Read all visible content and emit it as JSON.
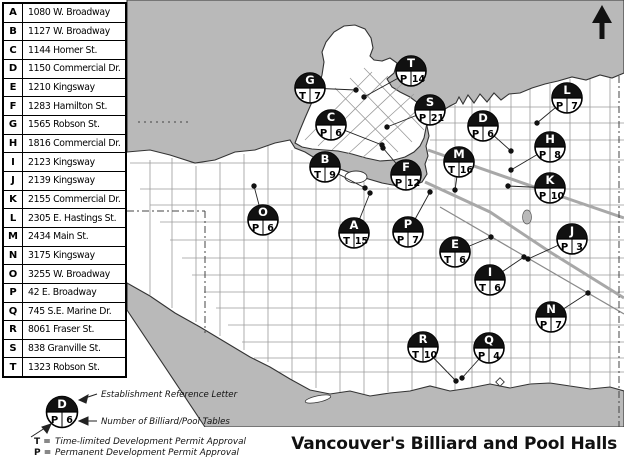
{
  "title": "Vancouver's Billiard and Pool Halls",
  "table": {
    "rows": [
      {
        "letter": "A",
        "address": "1080 W. Broadway"
      },
      {
        "letter": "B",
        "address": "1127 W. Broadway"
      },
      {
        "letter": "C",
        "address": "1144 Homer St."
      },
      {
        "letter": "D",
        "address": "1150 Commercial Dr."
      },
      {
        "letter": "E",
        "address": "1210 Kingsway"
      },
      {
        "letter": "F",
        "address": "1283 Hamilton St."
      },
      {
        "letter": "G",
        "address": "1565 Robson St."
      },
      {
        "letter": "H",
        "address": "1816 Commercial Dr."
      },
      {
        "letter": "I",
        "address": "2123 Kingsway"
      },
      {
        "letter": "J",
        "address": "2139 Kingsway"
      },
      {
        "letter": "K",
        "address": "2155 Commercial Dr."
      },
      {
        "letter": "L",
        "address": "2305 E. Hastings St."
      },
      {
        "letter": "M",
        "address": "2434 Main St."
      },
      {
        "letter": "N",
        "address": "3175 Kingsway"
      },
      {
        "letter": "O",
        "address": "3255 W. Broadway"
      },
      {
        "letter": "P",
        "address": "42 E. Broadway"
      },
      {
        "letter": "Q",
        "address": "745 S.E. Marine Dr."
      },
      {
        "letter": "R",
        "address": "8061 Fraser St."
      },
      {
        "letter": "S",
        "address": "838 Granville St."
      },
      {
        "letter": "T",
        "address": "1323 Robson St."
      }
    ]
  },
  "legend": {
    "sample": {
      "letter": "D",
      "permit": "P",
      "tables": "6",
      "x": 62,
      "y": 34
    },
    "ref_label": "Establishment Reference Letter",
    "tables_label": "Number of Billiard/Pool Tables",
    "permit_lines": [
      {
        "symbol": "T =",
        "text": "Time-limited Development Permit Approval"
      },
      {
        "symbol": "P =",
        "text": "Permanent Development Permit Approval"
      }
    ]
  },
  "map": {
    "colors": {
      "water": "#b9b9b9",
      "land": "#ffffff",
      "street": "#9b9b9b",
      "major_road": "#a8a8a8",
      "marker_fill": "#111111",
      "outline": "#333333"
    },
    "markers": [
      {
        "letter": "A",
        "permit": "T",
        "tables": "15",
        "x": 354,
        "y": 233,
        "dotx": 370,
        "doty": 193
      },
      {
        "letter": "B",
        "permit": "T",
        "tables": "9",
        "x": 325,
        "y": 167,
        "dotx": 365,
        "doty": 188
      },
      {
        "letter": "C",
        "permit": "P",
        "tables": "6",
        "x": 331,
        "y": 125,
        "dotx": 382,
        "doty": 145
      },
      {
        "letter": "D",
        "permit": "P",
        "tables": "6",
        "x": 483,
        "y": 126,
        "dotx": 511,
        "doty": 151
      },
      {
        "letter": "E",
        "permit": "T",
        "tables": "6",
        "x": 455,
        "y": 252,
        "dotx": 491,
        "doty": 237
      },
      {
        "letter": "F",
        "permit": "P",
        "tables": "12",
        "x": 406,
        "y": 175,
        "dotx": 383,
        "doty": 148
      },
      {
        "letter": "G",
        "permit": "T",
        "tables": "7",
        "x": 310,
        "y": 88,
        "dotx": 356,
        "doty": 90
      },
      {
        "letter": "H",
        "permit": "P",
        "tables": "8",
        "x": 550,
        "y": 147,
        "dotx": 511,
        "doty": 170
      },
      {
        "letter": "I",
        "permit": "T",
        "tables": "6",
        "x": 490,
        "y": 280,
        "dotx": 524,
        "doty": 257
      },
      {
        "letter": "J",
        "permit": "P",
        "tables": "3",
        "x": 572,
        "y": 239,
        "dotx": 528,
        "doty": 259
      },
      {
        "letter": "K",
        "permit": "P",
        "tables": "10",
        "x": 550,
        "y": 188,
        "dotx": 508,
        "doty": 186
      },
      {
        "letter": "L",
        "permit": "P",
        "tables": "7",
        "x": 567,
        "y": 98,
        "dotx": 537,
        "doty": 123
      },
      {
        "letter": "M",
        "permit": "T",
        "tables": "16",
        "x": 459,
        "y": 162,
        "dotx": 455,
        "doty": 190
      },
      {
        "letter": "N",
        "permit": "P",
        "tables": "7",
        "x": 551,
        "y": 317,
        "dotx": 588,
        "doty": 293
      },
      {
        "letter": "O",
        "permit": "P",
        "tables": "6",
        "x": 263,
        "y": 220,
        "dotx": 254,
        "doty": 186
      },
      {
        "letter": "P",
        "permit": "P",
        "tables": "7",
        "x": 408,
        "y": 232,
        "dotx": 430,
        "doty": 192
      },
      {
        "letter": "Q",
        "permit": "P",
        "tables": "4",
        "x": 489,
        "y": 348,
        "dotx": 462,
        "doty": 378
      },
      {
        "letter": "R",
        "permit": "T",
        "tables": "10",
        "x": 423,
        "y": 347,
        "dotx": 456,
        "doty": 381
      },
      {
        "letter": "S",
        "permit": "P",
        "tables": "21",
        "x": 430,
        "y": 110,
        "dotx": 387,
        "doty": 127
      },
      {
        "letter": "T",
        "permit": "P",
        "tables": "14",
        "x": 411,
        "y": 71,
        "dotx": 364,
        "doty": 97
      }
    ]
  }
}
